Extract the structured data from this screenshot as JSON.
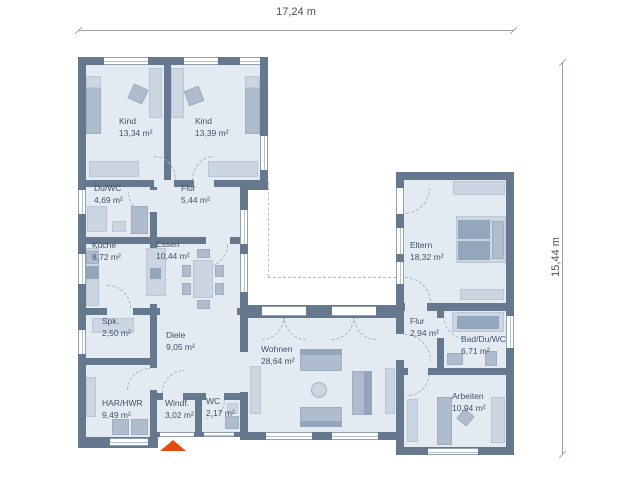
{
  "dimensions": {
    "width_label": "17,24 m",
    "height_label": "15,44 m"
  },
  "rooms": [
    {
      "id": "kind1",
      "name": "Kind",
      "area": "13,34 m²"
    },
    {
      "id": "kind2",
      "name": "Kind",
      "area": "13,39 m²"
    },
    {
      "id": "duwc",
      "name": "Du/WC",
      "area": "4,69 m²"
    },
    {
      "id": "flur1",
      "name": "Flur",
      "area": "5,44 m²"
    },
    {
      "id": "kueche",
      "name": "Küche",
      "area": "8,72 m²"
    },
    {
      "id": "essen",
      "name": "Essen",
      "area": "10,44 m²"
    },
    {
      "id": "eltern",
      "name": "Eltern",
      "area": "18,32 m²"
    },
    {
      "id": "spk",
      "name": "Spk.",
      "area": "2,50 m²"
    },
    {
      "id": "diele",
      "name": "Diele",
      "area": "9,05 m²"
    },
    {
      "id": "harhwr",
      "name": "HAR/HWR",
      "area": "9,49 m²"
    },
    {
      "id": "windf",
      "name": "Windf.",
      "area": "3,02 m²"
    },
    {
      "id": "wc",
      "name": "WC",
      "area": "2,17 m²"
    },
    {
      "id": "wohnen",
      "name": "Wohnen",
      "area": "28,64 m²"
    },
    {
      "id": "flur2",
      "name": "Flur",
      "area": "2,94 m²"
    },
    {
      "id": "bad",
      "name": "Bad/Du/WC",
      "area": "6,71 m²"
    },
    {
      "id": "arbeiten",
      "name": "Arbeiten",
      "area": "10,94 m²"
    }
  ],
  "colors": {
    "wall": "#66788e",
    "room_fill": "#e4eaf1",
    "furniture_light": "#ccd6e2",
    "furniture_dark": "#93a6bb",
    "entrance_arrow": "#e8490f"
  },
  "entrance_marker": {
    "symbol": "triangle-up"
  }
}
